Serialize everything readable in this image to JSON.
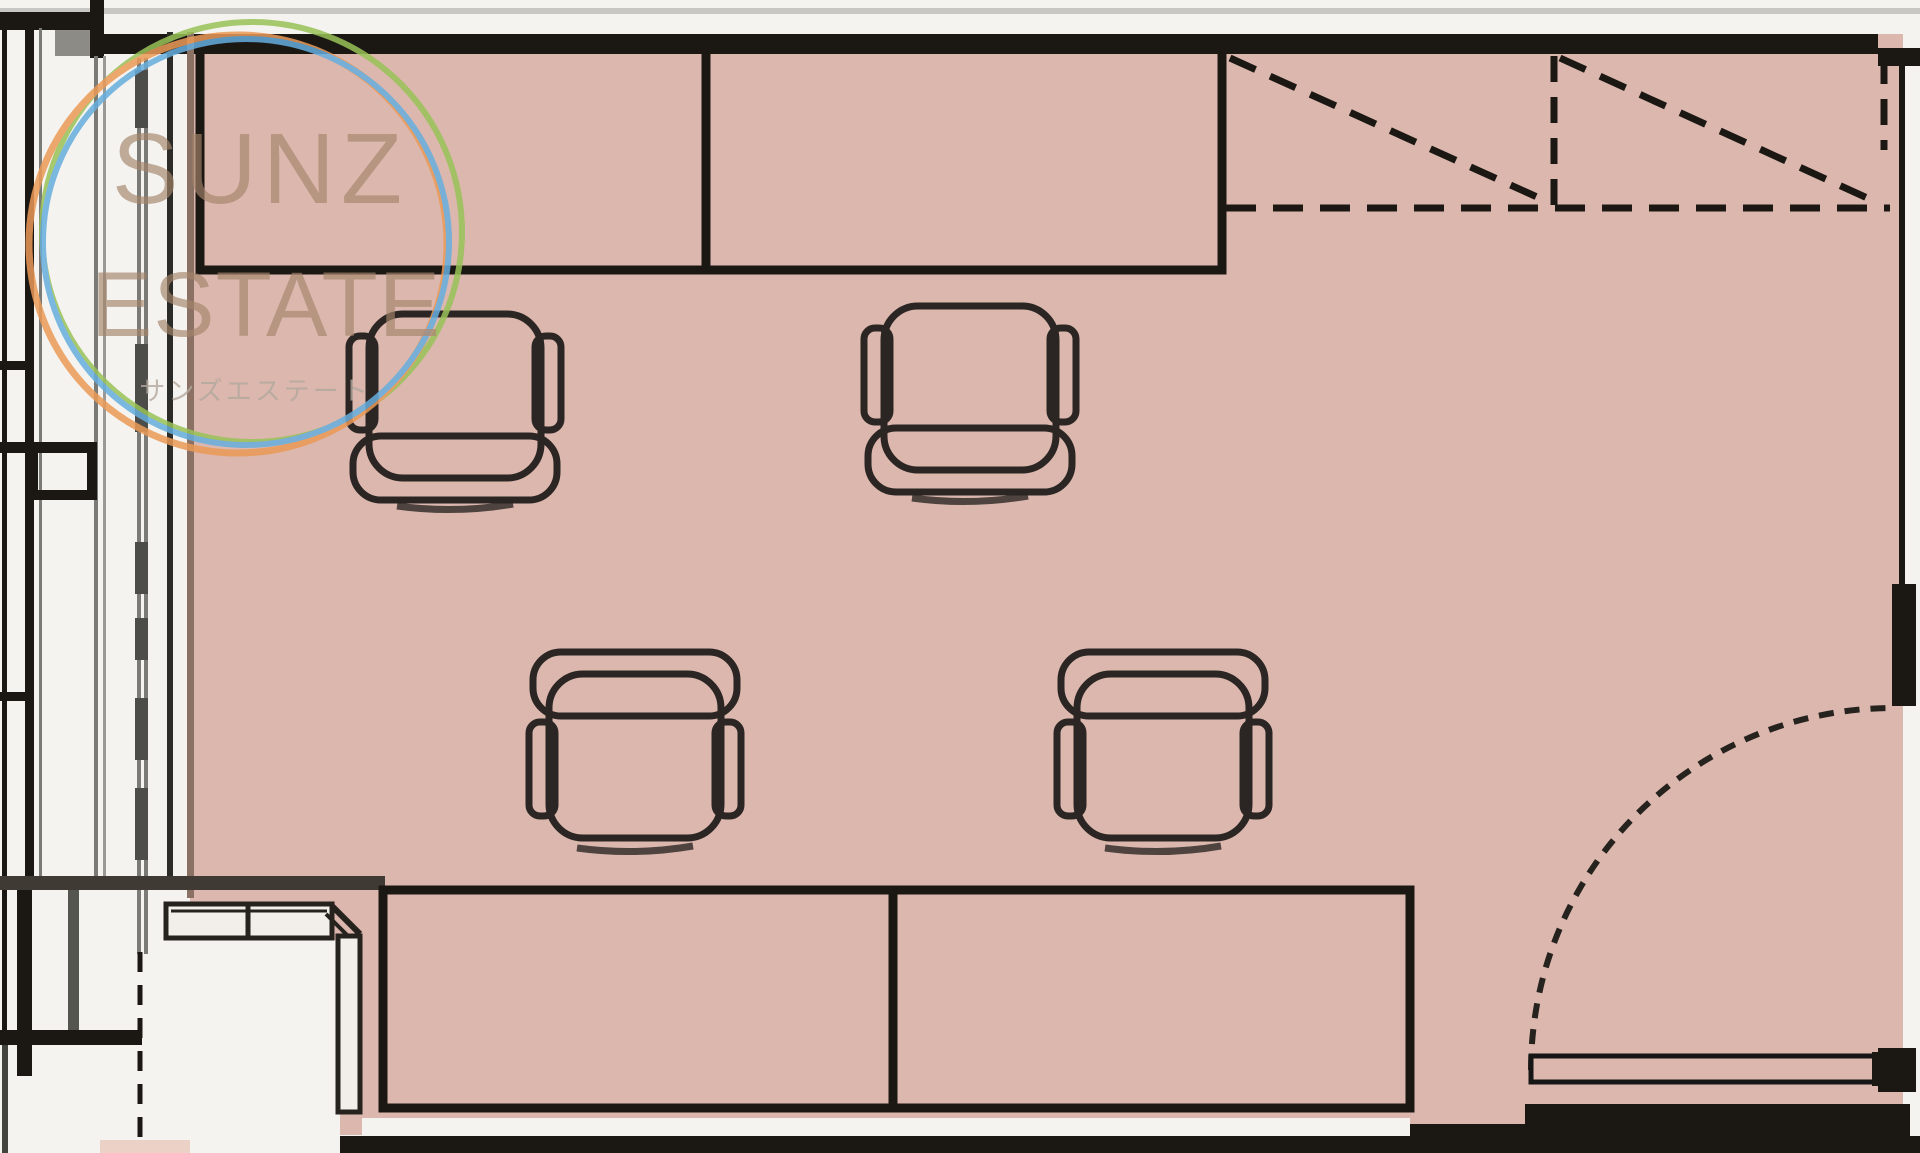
{
  "watermark": {
    "line1": "SUNZ",
    "line2": "ESTATE",
    "line3": "サンズエステート"
  },
  "plan": {
    "type": "floor-plan",
    "room_fill": "pink",
    "furniture": {
      "top_desk_sections": 2,
      "bottom_desk_sections": 2,
      "chairs": 4,
      "closet_bays_dashed": 2,
      "doors": 1,
      "side_counter": 1
    }
  },
  "colors": {
    "bg": "#f5f3f0",
    "floor": "#dcb7ae",
    "floor_accent": "#ecd2c6",
    "ink": "#1b1814",
    "chair_ink": "#2b2623",
    "dark_band": "#3f3a34",
    "brown_edge": "#8a7164",
    "mullion_gray": "#7a7a76",
    "mullion_dark": "#4c4c48",
    "mullion_light": "#9a9995",
    "corner_gray": "#8d8b86",
    "top_gray_line": "#c9c7c3",
    "counter_fill": "#f2efeb",
    "logo_orange": "#eb9a57",
    "logo_blue": "#66aede",
    "logo_green": "#99c258",
    "logo_text": "#a5846b",
    "logo_text_jp": "#b3a89e"
  }
}
